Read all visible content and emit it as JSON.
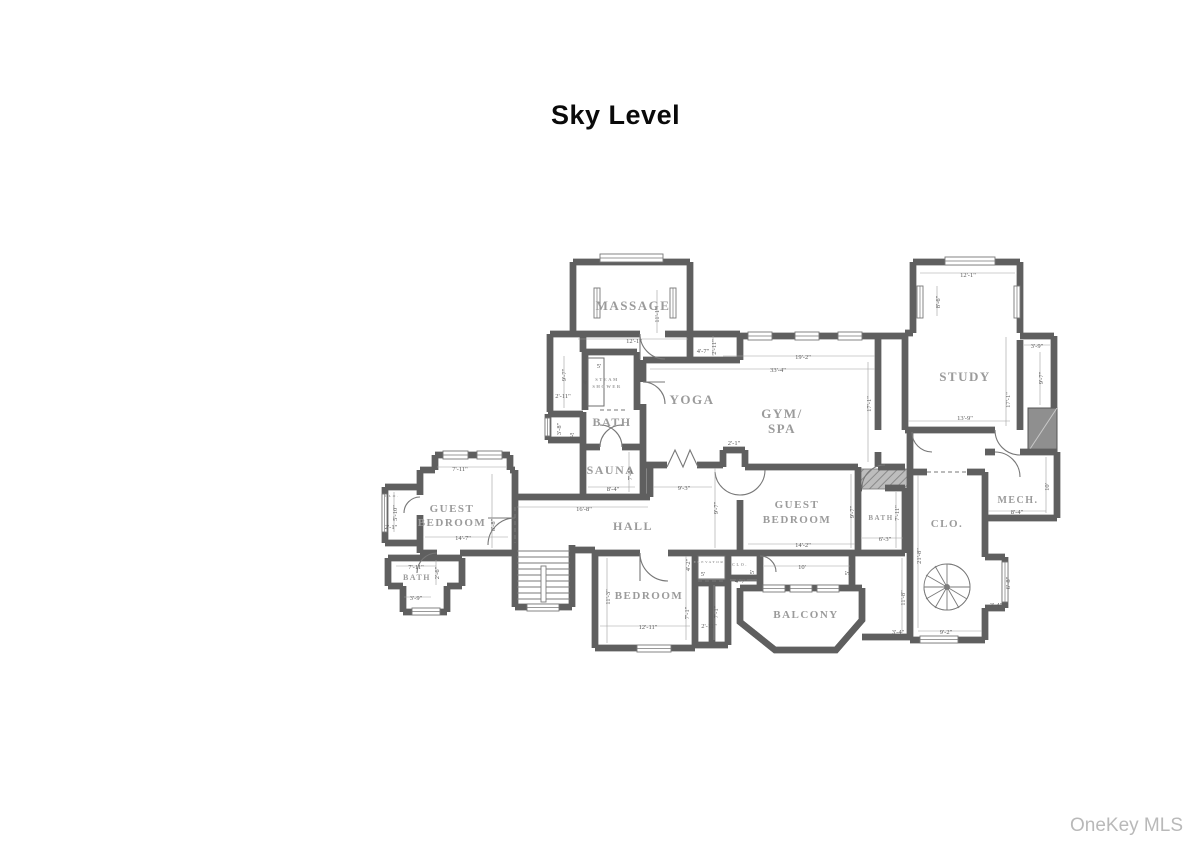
{
  "title": "Sky Level",
  "watermark": "OneKey MLS",
  "colors": {
    "wall_core": "#ababab",
    "wall_edge": "#5f5f5f",
    "label": "#9b9b9b",
    "dim_text": "#5a5a5a",
    "shaft_fill": "#8f8f8f",
    "title": "#0a0a0a",
    "watermark": "#b9b9b9"
  },
  "floorplan": {
    "rooms": [
      {
        "t": "MASSAGE",
        "x": 633,
        "y": 310,
        "s": 13
      },
      {
        "t": "YOGA",
        "x": 692,
        "y": 404,
        "s": 13
      },
      {
        "t": "GYM/",
        "x": 782,
        "y": 418,
        "s": 13
      },
      {
        "t": "SPA",
        "x": 782,
        "y": 433,
        "s": 13
      },
      {
        "t": "STUDY",
        "x": 965,
        "y": 381,
        "s": 13
      },
      {
        "t": "BATH",
        "x": 612,
        "y": 426,
        "s": 12
      },
      {
        "t": "SAUNA",
        "x": 611,
        "y": 474,
        "s": 12
      },
      {
        "t": "HALL",
        "x": 633,
        "y": 530,
        "s": 12
      },
      {
        "t": "GUEST",
        "x": 452,
        "y": 512,
        "s": 11
      },
      {
        "t": "BEDROOM",
        "x": 452,
        "y": 526,
        "s": 11
      },
      {
        "t": "GUEST",
        "x": 797,
        "y": 508,
        "s": 11
      },
      {
        "t": "BEDROOM",
        "x": 797,
        "y": 523,
        "s": 11
      },
      {
        "t": "BEDROOM",
        "x": 649,
        "y": 599,
        "s": 11
      },
      {
        "t": "BALCONY",
        "x": 806,
        "y": 618,
        "s": 11
      },
      {
        "t": "MECH.",
        "x": 1018,
        "y": 503,
        "s": 10
      },
      {
        "t": "CLO.",
        "x": 947,
        "y": 527,
        "s": 11
      },
      {
        "t": "BATH",
        "x": 417,
        "y": 580,
        "s": 8
      },
      {
        "t": "BATH",
        "x": 881,
        "y": 520,
        "s": 7
      },
      {
        "t": "STEAM",
        "x": 607,
        "y": 381,
        "s": 4.5
      },
      {
        "t": "SHOWER",
        "x": 607,
        "y": 388,
        "s": 4.5
      },
      {
        "t": "ELEVATOR",
        "x": 709,
        "y": 563,
        "s": 3.5
      },
      {
        "t": "CLO.",
        "x": 740,
        "y": 566,
        "s": 4
      },
      {
        "t": "CLO.",
        "x": 392,
        "y": 497,
        "s": 3.5
      }
    ],
    "dims": [
      {
        "t": "12'-1\"",
        "x": 634,
        "y": 343
      },
      {
        "t": "11'-1\"",
        "x": 659,
        "y": 315,
        "v": 1
      },
      {
        "t": "9'-7\"",
        "x": 566,
        "y": 375,
        "v": 1
      },
      {
        "t": "2'-11\"",
        "x": 563,
        "y": 398
      },
      {
        "t": "5'",
        "x": 599,
        "y": 368
      },
      {
        "t": "4'",
        "x": 587,
        "y": 382,
        "v": 1
      },
      {
        "t": "3'-8\"",
        "x": 561,
        "y": 429,
        "v": 1
      },
      {
        "t": "5'",
        "x": 572,
        "y": 437
      },
      {
        "t": "8'-4\"",
        "x": 613,
        "y": 491
      },
      {
        "t": "7'-6\"",
        "x": 632,
        "y": 474,
        "v": 1
      },
      {
        "t": "16'-8\"",
        "x": 584,
        "y": 511
      },
      {
        "t": "4'-7\"",
        "x": 703,
        "y": 353
      },
      {
        "t": "2'-11\"",
        "x": 716,
        "y": 347,
        "v": 1
      },
      {
        "t": "19'-2\"",
        "x": 803,
        "y": 359
      },
      {
        "t": "33'-4\"",
        "x": 778,
        "y": 372
      },
      {
        "t": "17'-1\"",
        "x": 871,
        "y": 404,
        "v": 1
      },
      {
        "t": "2'-1\"",
        "x": 734,
        "y": 445
      },
      {
        "t": "9'-3\"",
        "x": 684,
        "y": 490
      },
      {
        "t": "9'-7\"",
        "x": 718,
        "y": 508,
        "v": 1
      },
      {
        "t": "12'-1\"",
        "x": 968,
        "y": 277
      },
      {
        "t": "8'-6\"",
        "x": 940,
        "y": 302,
        "v": 1
      },
      {
        "t": "3'-9\"",
        "x": 1037,
        "y": 348
      },
      {
        "t": "9'-7\"",
        "x": 1043,
        "y": 378,
        "v": 1
      },
      {
        "t": "17'-1\"",
        "x": 1010,
        "y": 400,
        "v": 1
      },
      {
        "t": "13'-9\"",
        "x": 965,
        "y": 420
      },
      {
        "t": "10'",
        "x": 1049,
        "y": 487,
        "v": 1
      },
      {
        "t": "8'-4\"",
        "x": 1017,
        "y": 514
      },
      {
        "t": "21'-8\"",
        "x": 921,
        "y": 556,
        "v": 1
      },
      {
        "t": "6'-8\"",
        "x": 1010,
        "y": 583,
        "v": 1
      },
      {
        "t": "3'-4\"",
        "x": 996,
        "y": 607
      },
      {
        "t": "9'-2\"",
        "x": 946,
        "y": 634
      },
      {
        "t": "3'-4\"",
        "x": 898,
        "y": 634
      },
      {
        "t": "11'-8\"",
        "x": 905,
        "y": 598,
        "v": 1
      },
      {
        "t": "14'-2\"",
        "x": 803,
        "y": 547
      },
      {
        "t": "9'-7\"",
        "x": 854,
        "y": 512,
        "v": 1
      },
      {
        "t": "7'-11\"",
        "x": 899,
        "y": 513,
        "v": 1
      },
      {
        "t": "6'-3\"",
        "x": 885,
        "y": 541
      },
      {
        "t": "10'",
        "x": 802,
        "y": 569
      },
      {
        "t": "5'",
        "x": 754,
        "y": 572,
        "v": 1
      },
      {
        "t": "5'",
        "x": 849,
        "y": 573,
        "v": 1
      },
      {
        "t": "4'-7\"",
        "x": 741,
        "y": 583
      },
      {
        "t": "7'-11\"",
        "x": 460,
        "y": 471
      },
      {
        "t": "14'-7\"",
        "x": 463,
        "y": 540
      },
      {
        "t": "8'-8\"",
        "x": 495,
        "y": 525,
        "v": 1
      },
      {
        "t": "5'-10\"",
        "x": 397,
        "y": 513,
        "v": 1
      },
      {
        "t": "2'-1\"",
        "x": 391,
        "y": 529
      },
      {
        "t": "7'-11\"",
        "x": 416,
        "y": 569
      },
      {
        "t": "2'-6\"",
        "x": 439,
        "y": 573,
        "v": 1
      },
      {
        "t": "3'-9\"",
        "x": 416,
        "y": 600
      },
      {
        "t": "11'-3\"",
        "x": 610,
        "y": 597,
        "v": 1
      },
      {
        "t": "12'-11\"",
        "x": 648,
        "y": 629
      },
      {
        "t": "4'-2\"",
        "x": 690,
        "y": 565,
        "v": 1
      },
      {
        "t": "5'",
        "x": 703,
        "y": 576
      },
      {
        "t": "7'-1\"",
        "x": 689,
        "y": 613,
        "v": 1
      },
      {
        "t": "7'-1\"",
        "x": 718,
        "y": 612,
        "v": 1
      },
      {
        "t": "2'-11\"",
        "x": 709,
        "y": 628
      }
    ]
  }
}
